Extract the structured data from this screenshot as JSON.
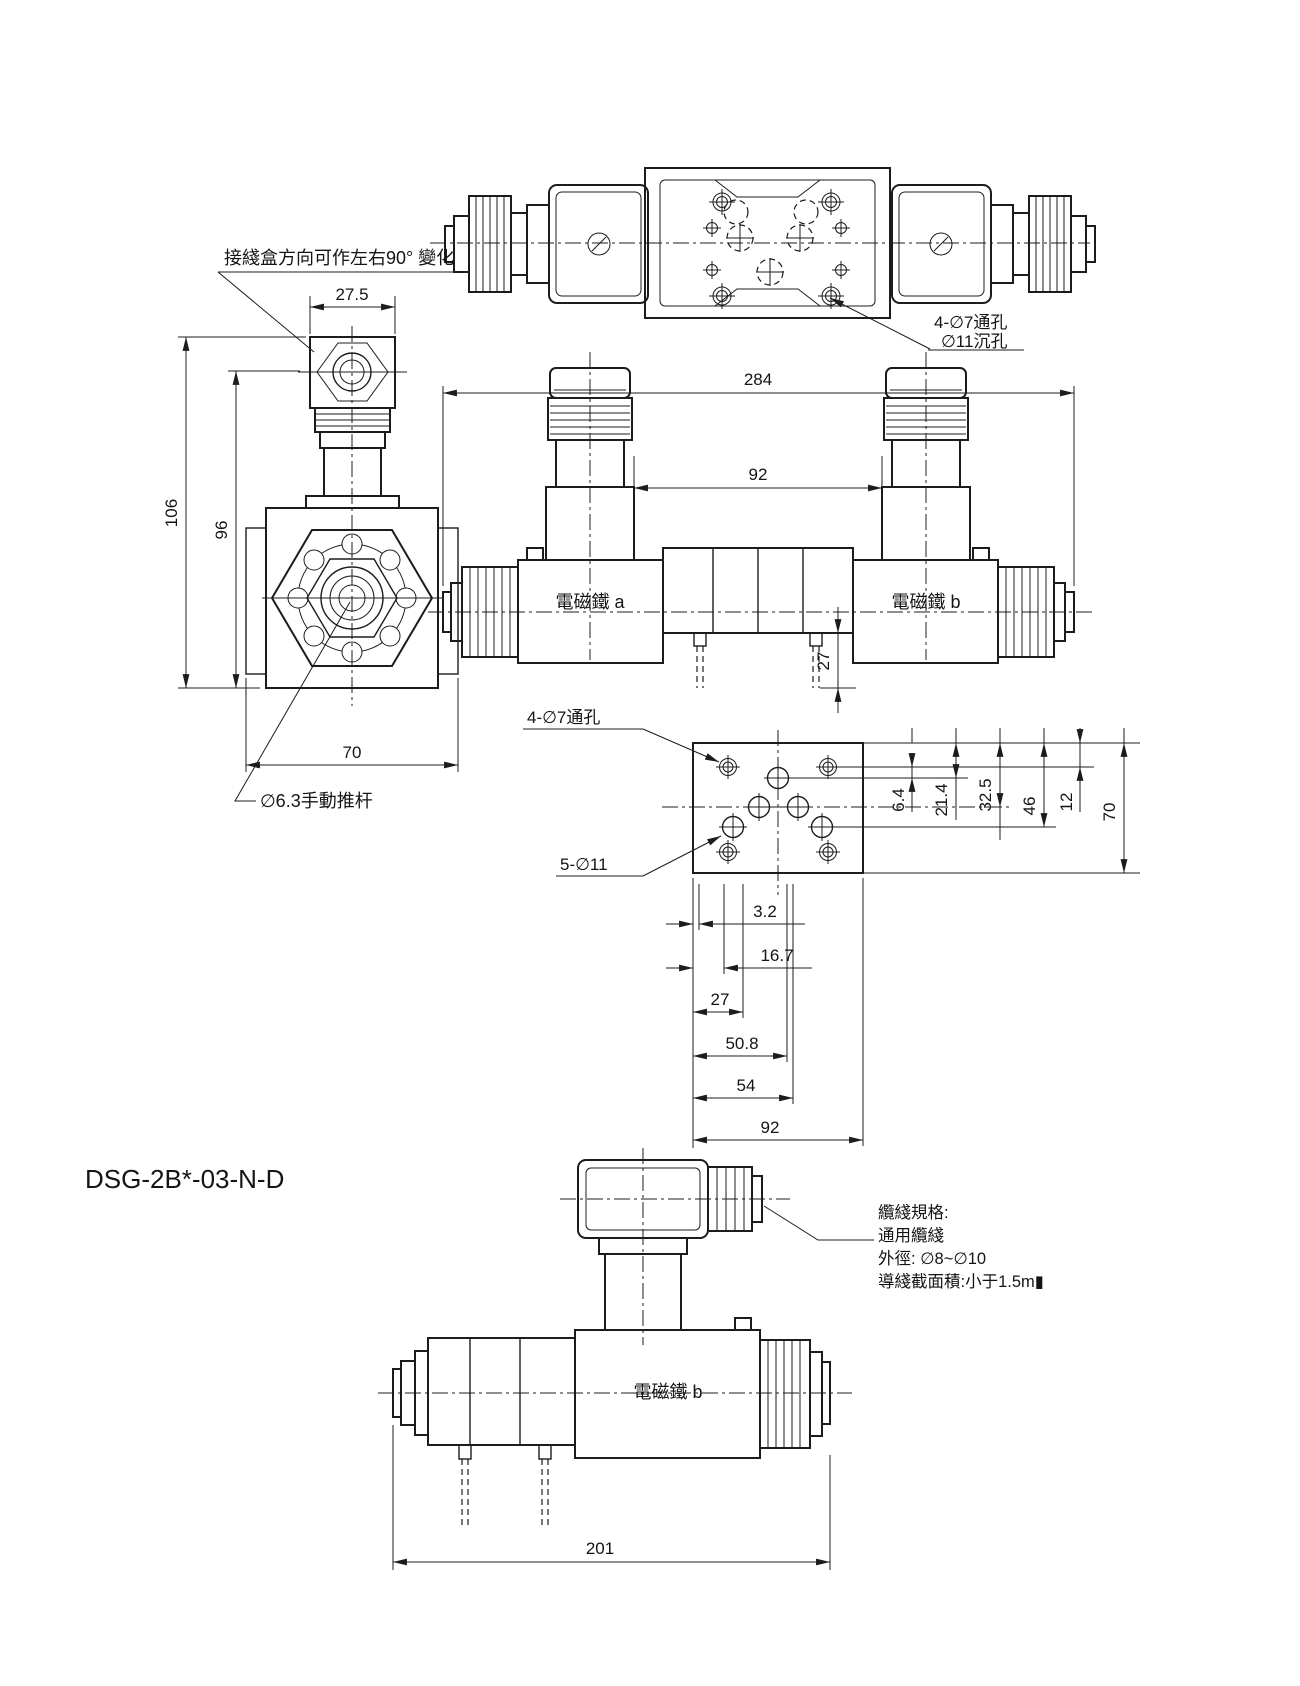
{
  "page": {
    "background": "#ffffff",
    "line_color": "#1c1c1c",
    "title": "DSG-2B*-03-N-D"
  },
  "side_view": {
    "note_junction_box": "接綫盒方向可作左右90° 變化",
    "dim_connector_width": "27.5",
    "dim_overall_height": "106",
    "dim_sub_height": "96",
    "dim_body_width": "70",
    "note_manual_pin": "∅6.3手動推杆"
  },
  "top_view": {
    "note_mount_hole_line1": "4-∅7通孔",
    "note_mount_hole_line2": "∅11沉孔"
  },
  "front_view": {
    "dim_overall_length": "284",
    "dim_connector_span": "92",
    "dim_stud_height": "27",
    "label_solenoid_a": "電磁鐵 a",
    "label_solenoid_b": "電磁鐵 b"
  },
  "plate_view": {
    "note_through_holes": "4-∅7通孔",
    "note_port_holes": "5-∅11",
    "dims_vertical": [
      "6.4",
      "21.4",
      "32.5",
      "46",
      "12",
      "70"
    ],
    "dims_horizontal": [
      "3.2",
      "16.7",
      "27",
      "50.8",
      "54",
      "92"
    ]
  },
  "bottom_view": {
    "label_solenoid_b": "電磁鐵 b",
    "dim_overall_length": "201",
    "cable_note": [
      "纜綫規格:",
      "通用纜綫",
      "外徑: ∅8~∅10",
      "導綫截面積:小于1.5m▮"
    ]
  }
}
